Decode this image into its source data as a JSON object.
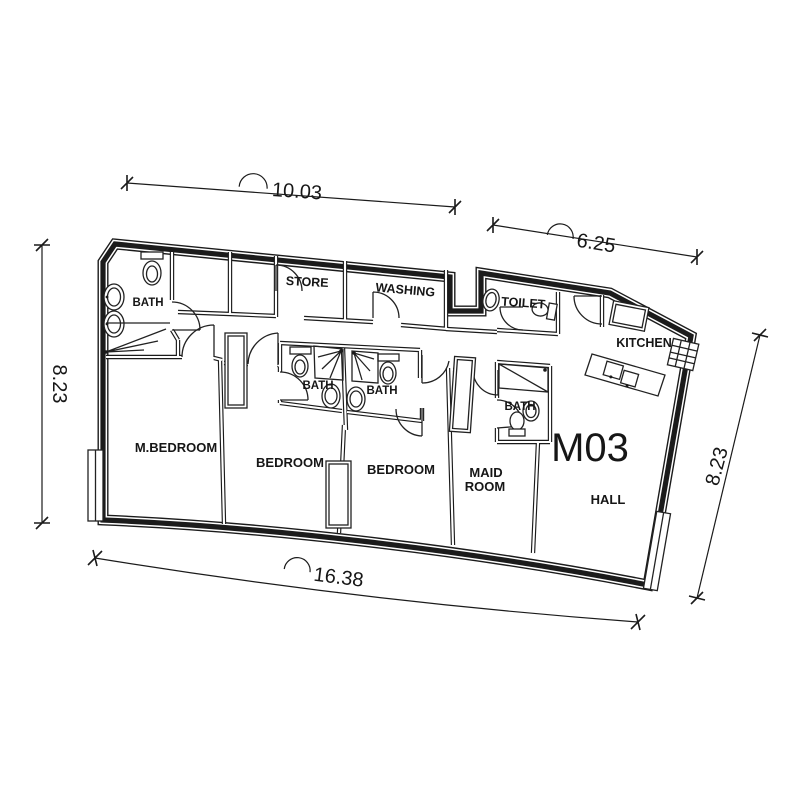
{
  "unit": {
    "label": "M03"
  },
  "rooms": {
    "m_bedroom": "M.BEDROOM",
    "bedroom_1": "BEDROOM",
    "bedroom_2": "BEDROOM",
    "maid_room_line_1": "MAID",
    "maid_room_line_2": "ROOM",
    "hall": "HALL",
    "kitchen": "KITCHEN",
    "toilet": "TOILET",
    "store": "STORE",
    "washing": "WASHING",
    "bath_master": "BATH",
    "bath_1": "BATH",
    "bath_2": "BATH",
    "bath_maid": "BATH"
  },
  "dimensions": {
    "top_left": "10.03",
    "top_right": "6.25",
    "left": "8.23",
    "right": "8.23",
    "bottom": "16.38"
  },
  "colors": {
    "ink": "#1b1b1b",
    "background": "#ffffff"
  }
}
